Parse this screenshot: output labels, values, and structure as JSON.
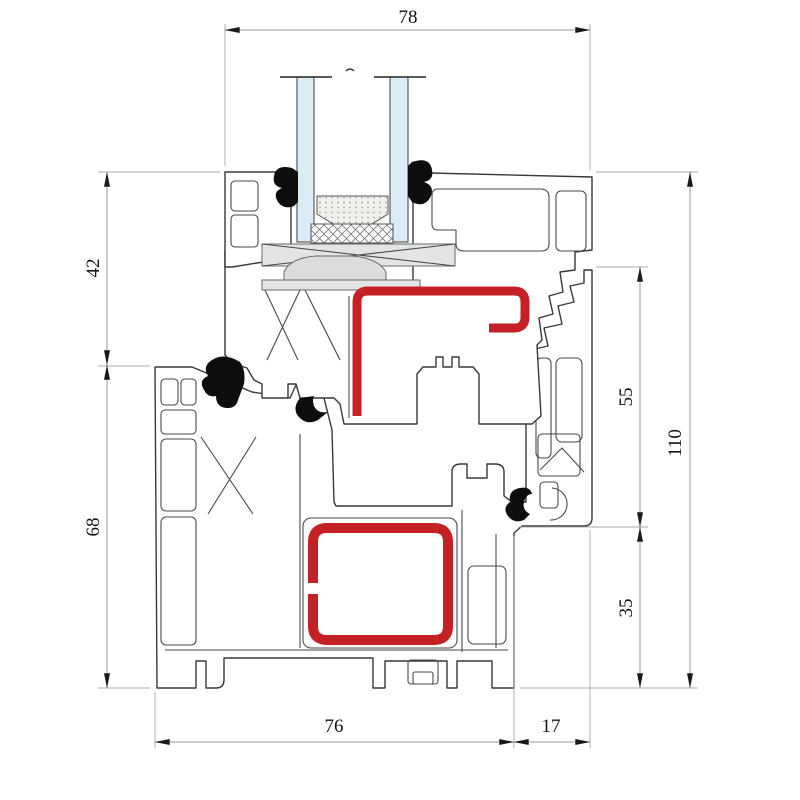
{
  "drawing": {
    "kind": "window-profile-cross-section"
  },
  "dimensions": {
    "top_sash_width": {
      "label": "78"
    },
    "left_sash_height": {
      "label": "42"
    },
    "left_frame_height": {
      "label": "68"
    },
    "right_rebate_height": {
      "label": "55"
    },
    "right_total_height": {
      "label": "110"
    },
    "right_lower_height": {
      "label": "35"
    },
    "bottom_frame_width": {
      "label": "76"
    },
    "bottom_overlap_width": {
      "label": "17"
    }
  },
  "colors": {
    "reinforcement_red": "#c42127",
    "glass_blue": "#dcecf7",
    "gasket_black": "#0d0d0d",
    "outline": "#383838",
    "dim_line": "#9a9a9a"
  }
}
